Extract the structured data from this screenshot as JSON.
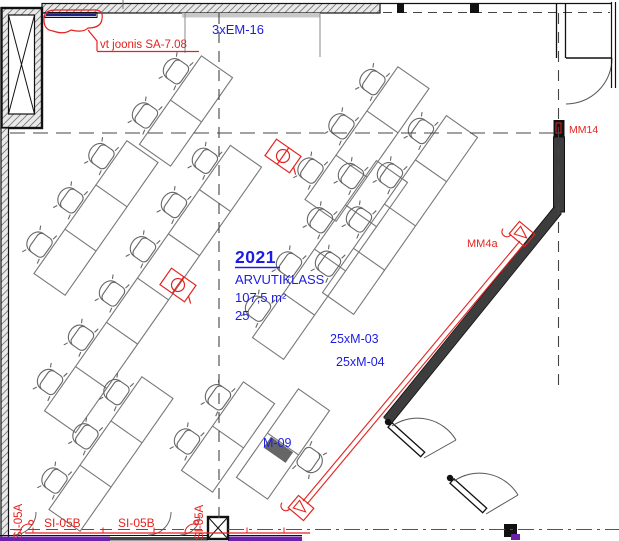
{
  "labels": {
    "revision_note": "vt joonis SA-7.08",
    "cable_tray_top": "3xEM-16",
    "room": {
      "number": "2021",
      "name": "ARVUTIKLASS",
      "area": "107,5 m²",
      "seats": "25"
    },
    "socket_group_1": "25xM-03",
    "socket_group_2": "25xM-04",
    "teacher_socket": "M-09",
    "device_wall": "MM4a",
    "device_door": "MM14",
    "riser_left": "SI-05A",
    "riser_mid": "SI-05A",
    "conduit_1": "SI-05B",
    "conduit_2": "SI-05B"
  },
  "colors": {
    "electrical_red": "#e42320",
    "label_blue": "#1d1de0",
    "tray_navy": "#232387",
    "busbar_purple": "#6B21A8"
  },
  "plan": {
    "angle": -55,
    "module_len": 54,
    "desk_depth": 38,
    "chair_offset": 30,
    "desk_banks": [
      {
        "x": 186,
        "y": 111,
        "n": 2
      },
      {
        "x": 96,
        "y": 218,
        "n": 3
      },
      {
        "x": 153,
        "y": 289,
        "n": 6
      },
      {
        "x": 111,
        "y": 454,
        "n": 3
      },
      {
        "x": 228,
        "y": 437,
        "n": 2
      },
      {
        "x": 367,
        "y": 144,
        "n": 3
      },
      {
        "x": 330,
        "y": 260,
        "n": 4
      },
      {
        "x": 400,
        "y": 215,
        "n": 4
      }
    ],
    "teacher_desk": {
      "x": 283,
      "y": 444
    },
    "floor_outlets": [
      {
        "x": 283,
        "y": 156
      },
      {
        "x": 178,
        "y": 285
      }
    ]
  }
}
